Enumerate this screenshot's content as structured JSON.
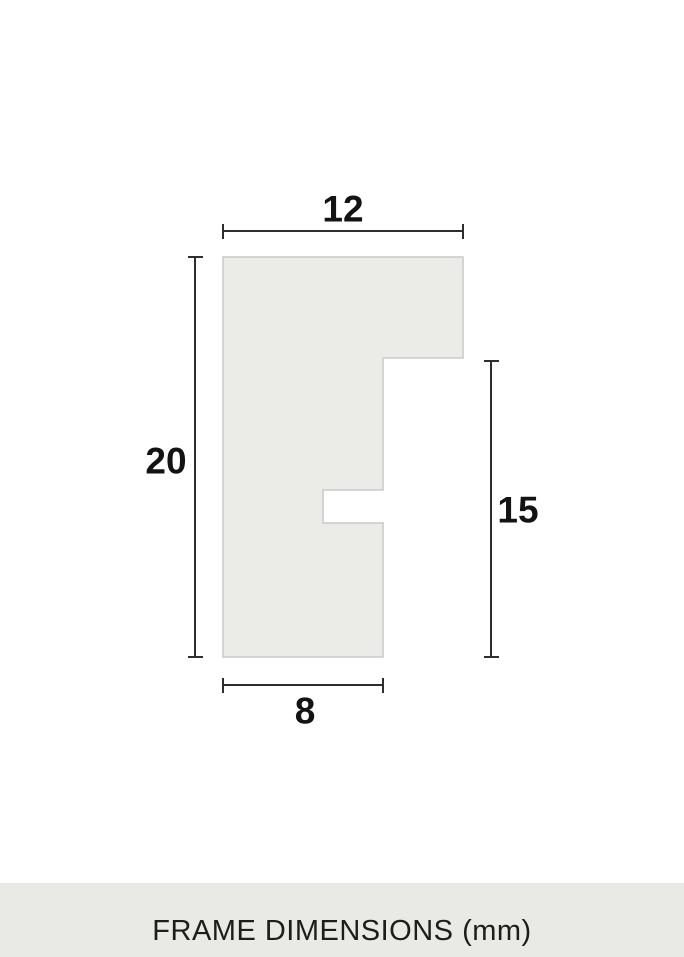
{
  "diagram": {
    "shape": {
      "name": "frame-profile-cross-section",
      "fill_color": "#ebebe7",
      "border_color": "#c9c9c6"
    },
    "dimension_line_color": "#2e2e2c",
    "label_color": "#131313",
    "dimensions": {
      "top_width": {
        "value": "12"
      },
      "left_height": {
        "value": "20"
      },
      "right_height": {
        "value": "15"
      },
      "bottom_width": {
        "value": "8"
      }
    }
  },
  "footer": {
    "label": "FRAME DIMENSIONS (mm)",
    "background_color": "#e9e9e6",
    "text_color": "#1d1d1b"
  }
}
